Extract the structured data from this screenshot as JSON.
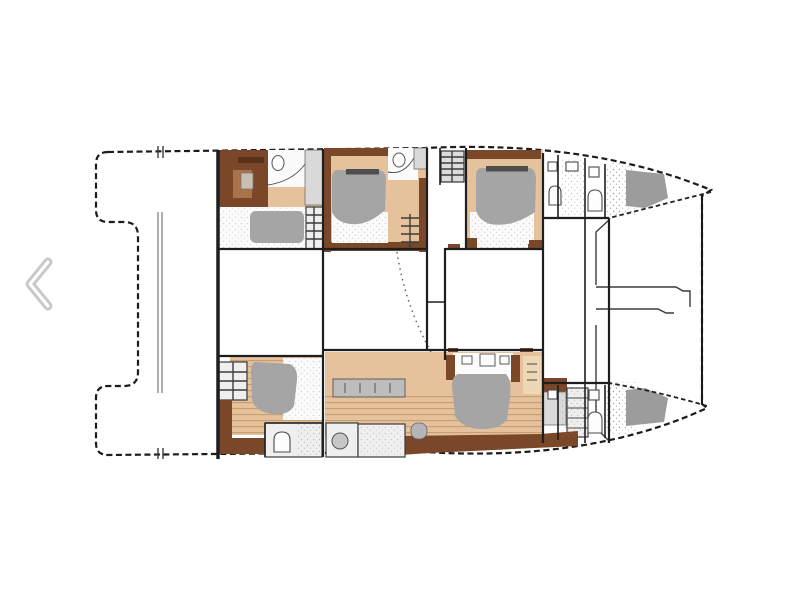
{
  "page": {
    "bg": "#ffffff"
  },
  "carousel": {
    "prev_chevron_icon": "chevron-left",
    "chevron_color": "#c9c9c9",
    "chevron_highlight": "#ffffff"
  },
  "floorplan": {
    "subject": "catamaran-yacht-deck-plan",
    "orientation": "bow-right",
    "colors": {
      "page_bg": "#ffffff",
      "deck": "#e4e4e4",
      "outline": "#1c1c1c",
      "wall": "#1e1e1e",
      "wood_dark": "#7a4729",
      "wood_mid": "#a9734a",
      "wood_desk": "#5a3119",
      "tan": "#e5c19c",
      "wood_light": "#eed7b5",
      "plank_line": "#c69c71",
      "duvet": "#a5a5a5",
      "headboard": "#4e4e4e",
      "linen": "#fbfbfb",
      "fixture": "#d9d9d9",
      "counter": "#bdbdbd",
      "bow_shade": "#9c9c9c",
      "stipple": "#8b8b8b",
      "chevron": "#c9c9c9"
    },
    "features": [
      "aft-cockpit",
      "cockpit-seam",
      "port-aft-cabin",
      "port-aft-bed",
      "port-aft-bathroom",
      "port-mid-cabin",
      "port-mid-bed",
      "port-mid-bathroom",
      "companionway-stairs",
      "port-forward-cabin",
      "port-forward-bed",
      "port-forward-bathroom",
      "port-bow",
      "saloon",
      "corridor",
      "owner-suite",
      "galley-counter",
      "starboard-aft-cabin",
      "starboard-aft-bed",
      "starboard-aft-bathroom",
      "starboard-owner-bed",
      "starboard-bathrooms",
      "starboard-forward-bathroom",
      "starboard-bow",
      "foredeck",
      "anchor-locker"
    ]
  }
}
